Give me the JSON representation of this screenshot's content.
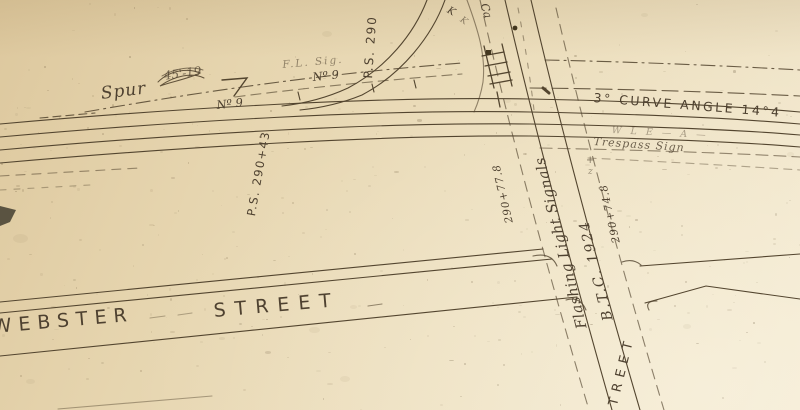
{
  "meta": {
    "description": "Photograph of an aged hand-drawn railroad track / street map (valuation plan) on yellowed paper",
    "paper_color": "#ecdebd",
    "ink_color": "#4e4130"
  },
  "labels": {
    "spur": "Spur",
    "spur_scribble": "45'-19",
    "ps_top": "P.S. 290",
    "ps_left": "P.S. 290+43",
    "switch_no": "Nº 9",
    "fl_sig": "F.L. Sig.",
    "curve_note": "3° CURVE ANGLE 14°4",
    "wire_note": "W L E — A —",
    "trespass": "Trespass Sign",
    "sta_west": "290+77.8",
    "sta_east": "290+74.8",
    "flashing_line1": "Flashing Light Signals",
    "flashing_line2": "B.T.C. 1924",
    "webster": "WEBSTER",
    "street": "STREET",
    "cross_street_partial": "TREET",
    "mark_k": "K",
    "mark_ca": "Ca",
    "mark_plus": "+",
    "mark_z": "z"
  }
}
